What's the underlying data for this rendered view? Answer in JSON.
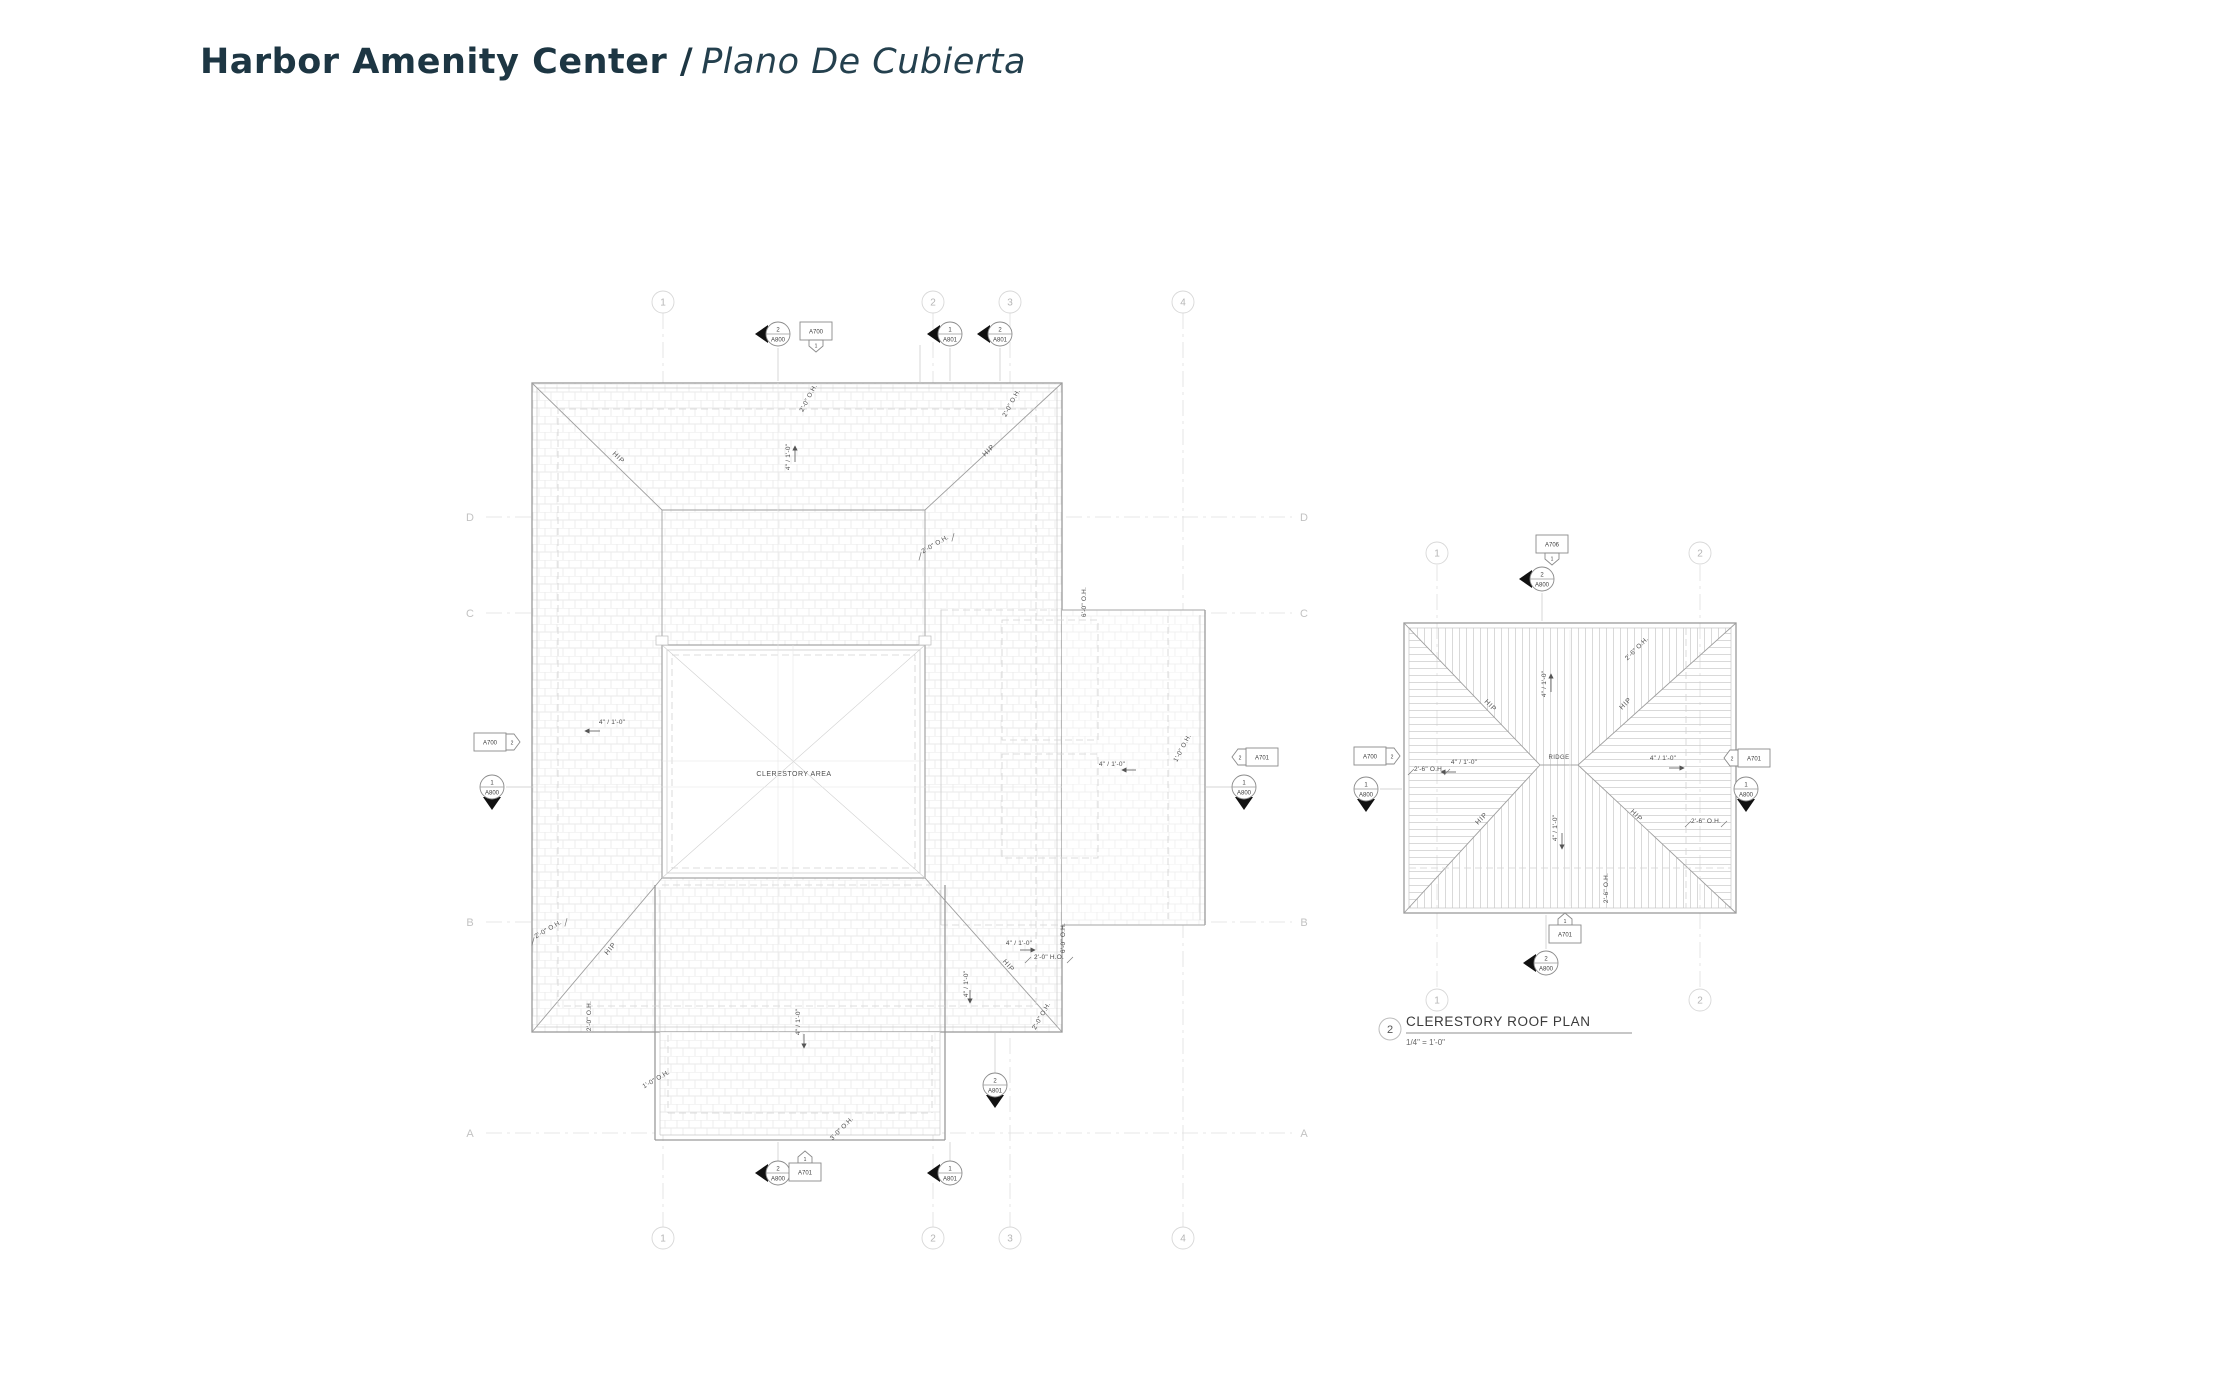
{
  "page": {
    "title_bold": "Harbor Amenity Center /",
    "title_italic": "Plano De Cubierta"
  },
  "colors": {
    "title_text": "#1d3643",
    "linework": "#9a9a9a",
    "annotation": "#4d4d4d",
    "grid_bubble": "#b5b5b5"
  },
  "grid": {
    "columns": [
      "1",
      "2",
      "3",
      "4"
    ],
    "rows": [
      "D",
      "C",
      "B",
      "A"
    ],
    "clerestory_columns": [
      "1",
      "2"
    ]
  },
  "labels": {
    "slope": "4\" / 1'-0\"",
    "hip": "HIP",
    "ridge": "RIDGE",
    "clerestory_area": "CLERESTORY AREA",
    "oh_2_0": "2'-0\" O.H.",
    "oh_2_0_alt": "2'-0\" H.O.",
    "oh_6_0": "6'-0\" O.H.",
    "oh_3_0": "3'-0\" O.H.",
    "oh_1_0": "1'-0\" O.H.",
    "oh_2_6": "2'-6\" O.H."
  },
  "callouts": {
    "n1": "1",
    "n2": "2",
    "a700": "A700",
    "a701": "A701",
    "a706": "A706",
    "a800": "A800",
    "a801": "A801"
  },
  "drawing2": {
    "number": "2",
    "title": "CLERESTORY ROOF PLAN",
    "scale": "1/4\" = 1'-0\""
  }
}
